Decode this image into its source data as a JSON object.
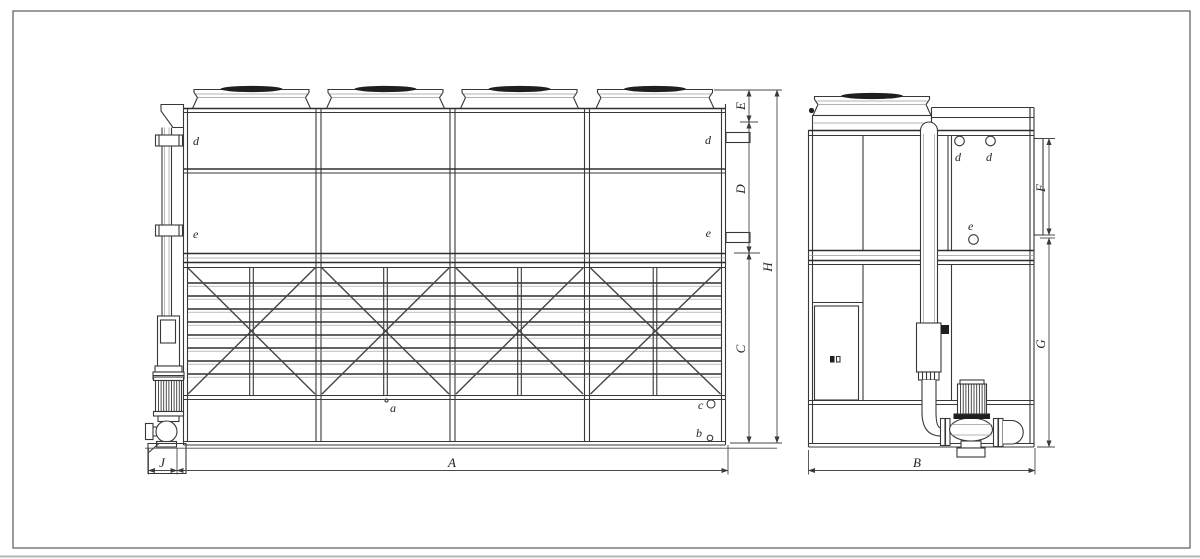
{
  "drawing": {
    "front_view": {
      "port_labels": {
        "d_left": "d",
        "d_right": "d",
        "e_left": "e",
        "e_right": "e",
        "a": "a",
        "b": "b",
        "c": "c"
      },
      "dimensions": {
        "A": "A",
        "J": "J",
        "E": "E",
        "D": "D",
        "C": "C",
        "H": "H"
      }
    },
    "side_view": {
      "port_labels": {
        "d_1": "d",
        "d_2": "d",
        "e": "e"
      },
      "dimensions": {
        "B": "B",
        "F": "F",
        "G": "G"
      }
    },
    "colors": {
      "line": "#383838",
      "background": "#ffffff"
    }
  }
}
